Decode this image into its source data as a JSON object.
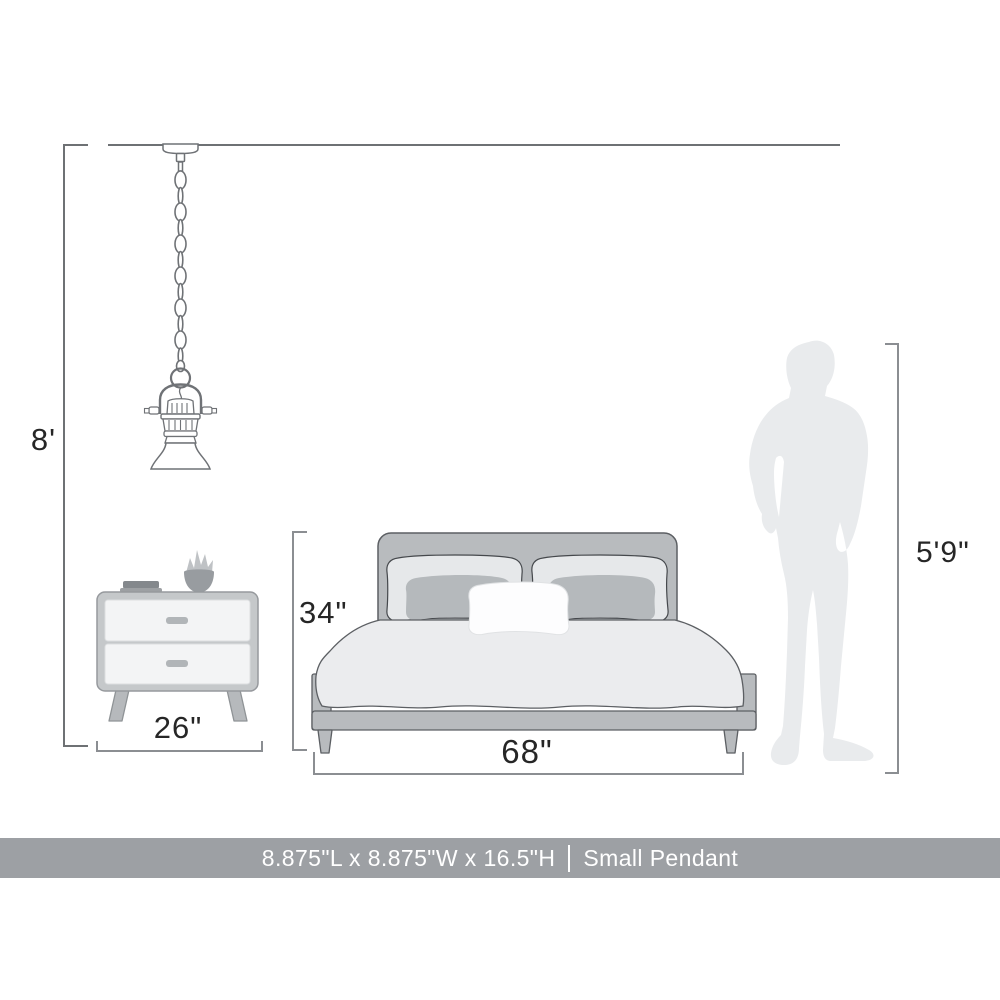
{
  "dimensions": {
    "ceiling_height_label": "8'",
    "nightstand_width_label": "26\"",
    "bed_height_label": "34\"",
    "bed_width_label": "68\"",
    "person_height_label": "5'9\""
  },
  "banner": {
    "product_dimensions": "8.875\"L x 8.875\"W x 16.5\"H",
    "separator": "|",
    "product_name": "Small Pendant",
    "background_color": "#9da0a4",
    "text_color": "#ffffff"
  },
  "scene": {
    "objects": [
      "pendant-light",
      "nightstand",
      "bed",
      "person-silhouette"
    ],
    "pendant_style": "small industrial pendant with chain",
    "person_represents": "average adult height reference"
  },
  "colors": {
    "line_art_stroke": "#6f7276",
    "dimension_line": "#8b8e92",
    "label_text": "#262626",
    "furniture_gray": "#b8bbbe",
    "bedding_gray": "#ebecee",
    "pillow_light": "#e6e8ea",
    "pillow_mid": "#b5b9bc",
    "silhouette_fill": "#e9ebed",
    "nightstand_drawer": "#f3f4f5"
  }
}
